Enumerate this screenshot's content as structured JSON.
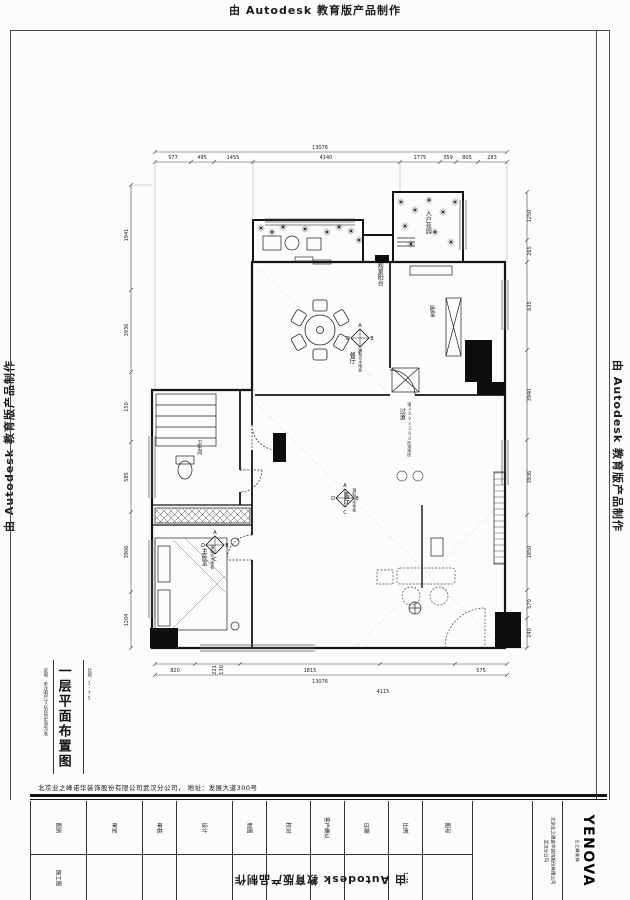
{
  "watermark": {
    "text": "由 Autodesk 教育版产品制作"
  },
  "sheet": {
    "main_title": "一层平面布置图",
    "side_note_left": "说明：未注明尺寸以现场实测为准",
    "side_note_right": "比例：1:75",
    "company_line": "北京业之峰诺华装饰股份有限公司武汉分公司， 地址：发展大道300号"
  },
  "title_block": {
    "cells": [
      {
        "label": "图别",
        "value": "施工图"
      },
      {
        "label": "审定",
        "value": ""
      },
      {
        "label": "审核",
        "value": ""
      },
      {
        "label": "设计",
        "value": ""
      },
      {
        "label": "制图",
        "value": ""
      },
      {
        "label": "校对",
        "value": ""
      },
      {
        "label": "客户确认",
        "value": ""
      },
      {
        "label": "日期",
        "value": ""
      },
      {
        "label": "比例",
        "value": "1:75"
      },
      {
        "label": "图号",
        "value": ""
      }
    ],
    "company_full": "北京业之峰诺华装饰股份有限公司",
    "branch": "武汉分公司",
    "brand": "YENOVA",
    "brand_sub": "业之峰装饰"
  },
  "plan": {
    "rooms": {
      "balcony": "观景阳台",
      "garden": "入户花园",
      "dining": "餐厅",
      "bedroom2": "卧室",
      "corridor": "过道",
      "bath": "卫生间",
      "master": "主卧室",
      "living": "客厅"
    },
    "notes": {
      "wood_dining": "铺贴实木地板",
      "wood_living": "铺贴实木地板",
      "wood_master": "铺贴实木地板",
      "tile_corridor": "铺300×300防滑地砖"
    },
    "elev": {
      "a": "A",
      "b": "B",
      "c": "C",
      "d": "D"
    },
    "dims": {
      "top_total": "13076",
      "top": [
        "577",
        "495",
        "1455",
        "4140",
        "1775",
        "359",
        "805",
        "283"
      ],
      "left": [
        "1941",
        "3936",
        "150",
        "585",
        "3906",
        "1204"
      ],
      "right": [
        "1250",
        "265",
        "635",
        "3940",
        "3936",
        "1850",
        "570",
        "240"
      ],
      "bottom": [
        "820",
        "221",
        "130",
        "1815",
        "575"
      ],
      "bottom_total": "13076",
      "bottom_sub": "4115"
    }
  }
}
